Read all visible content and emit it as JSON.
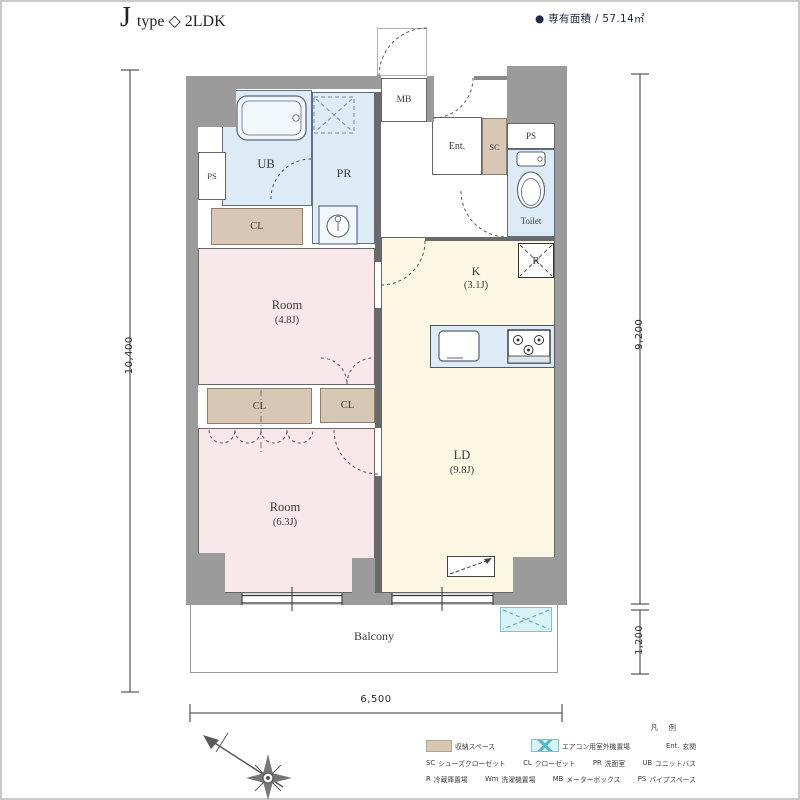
{
  "header": {
    "title_letter": "J",
    "title_rest": "type ◇ 2LDK",
    "area_note": "● 専有面積 / 57.14㎡"
  },
  "plan": {
    "labels": {
      "ub": "UB",
      "ps_left": "PS",
      "pr": "PR",
      "cl_top": "CL",
      "mb": "MB",
      "ent": "Ent.",
      "sc": "SC",
      "ps_top": "PS",
      "toilet": "Toilet",
      "fridge": "R",
      "kitchen": {
        "name": "K",
        "size": "(3.1J)"
      },
      "room1": {
        "name": "Room",
        "size": "(4.8J)"
      },
      "cl_mid_left": "CL",
      "cl_mid_right": "CL",
      "room2": {
        "name": "Room",
        "size": "(6.3J)"
      },
      "ld": {
        "name": "LD",
        "size": "(9.8J)"
      },
      "balcony": "Balcony"
    },
    "dimensions": {
      "left": "10,400",
      "right_main": "9,200",
      "right_balcony": "1,200",
      "bottom": "6,500"
    }
  },
  "legend": {
    "title": "凡 例",
    "row1": [
      {
        "swatch": "tan",
        "label": "収納スペース"
      },
      {
        "swatch": "cyan-x",
        "label": "エアコン用室外機置場"
      },
      {
        "abbr": "Ent.",
        "label": "玄関"
      }
    ],
    "row2": [
      {
        "abbr": "SC",
        "label": "シューズクローゼット"
      },
      {
        "abbr": "CL",
        "label": "クローゼット"
      },
      {
        "abbr": "PR",
        "label": "洗面室"
      },
      {
        "abbr": "UB",
        "label": "ユニットバス"
      }
    ],
    "row3": [
      {
        "abbr": "R",
        "label": "冷蔵庫置場"
      },
      {
        "abbr": "Wm",
        "label": "洗濯機置場"
      },
      {
        "abbr": "MB",
        "label": "メーターボックス"
      },
      {
        "abbr": "PS",
        "label": "パイプスペース"
      }
    ]
  },
  "colors": {
    "wall": "#9b9b9b",
    "room_pink": "#f8e7eb",
    "ldk_cream": "#fbf7e2",
    "water_blue": "#dcebf5",
    "closet_tan": "#d7c7b4",
    "outdoor_unit_cyan": "#d9f2f6"
  }
}
